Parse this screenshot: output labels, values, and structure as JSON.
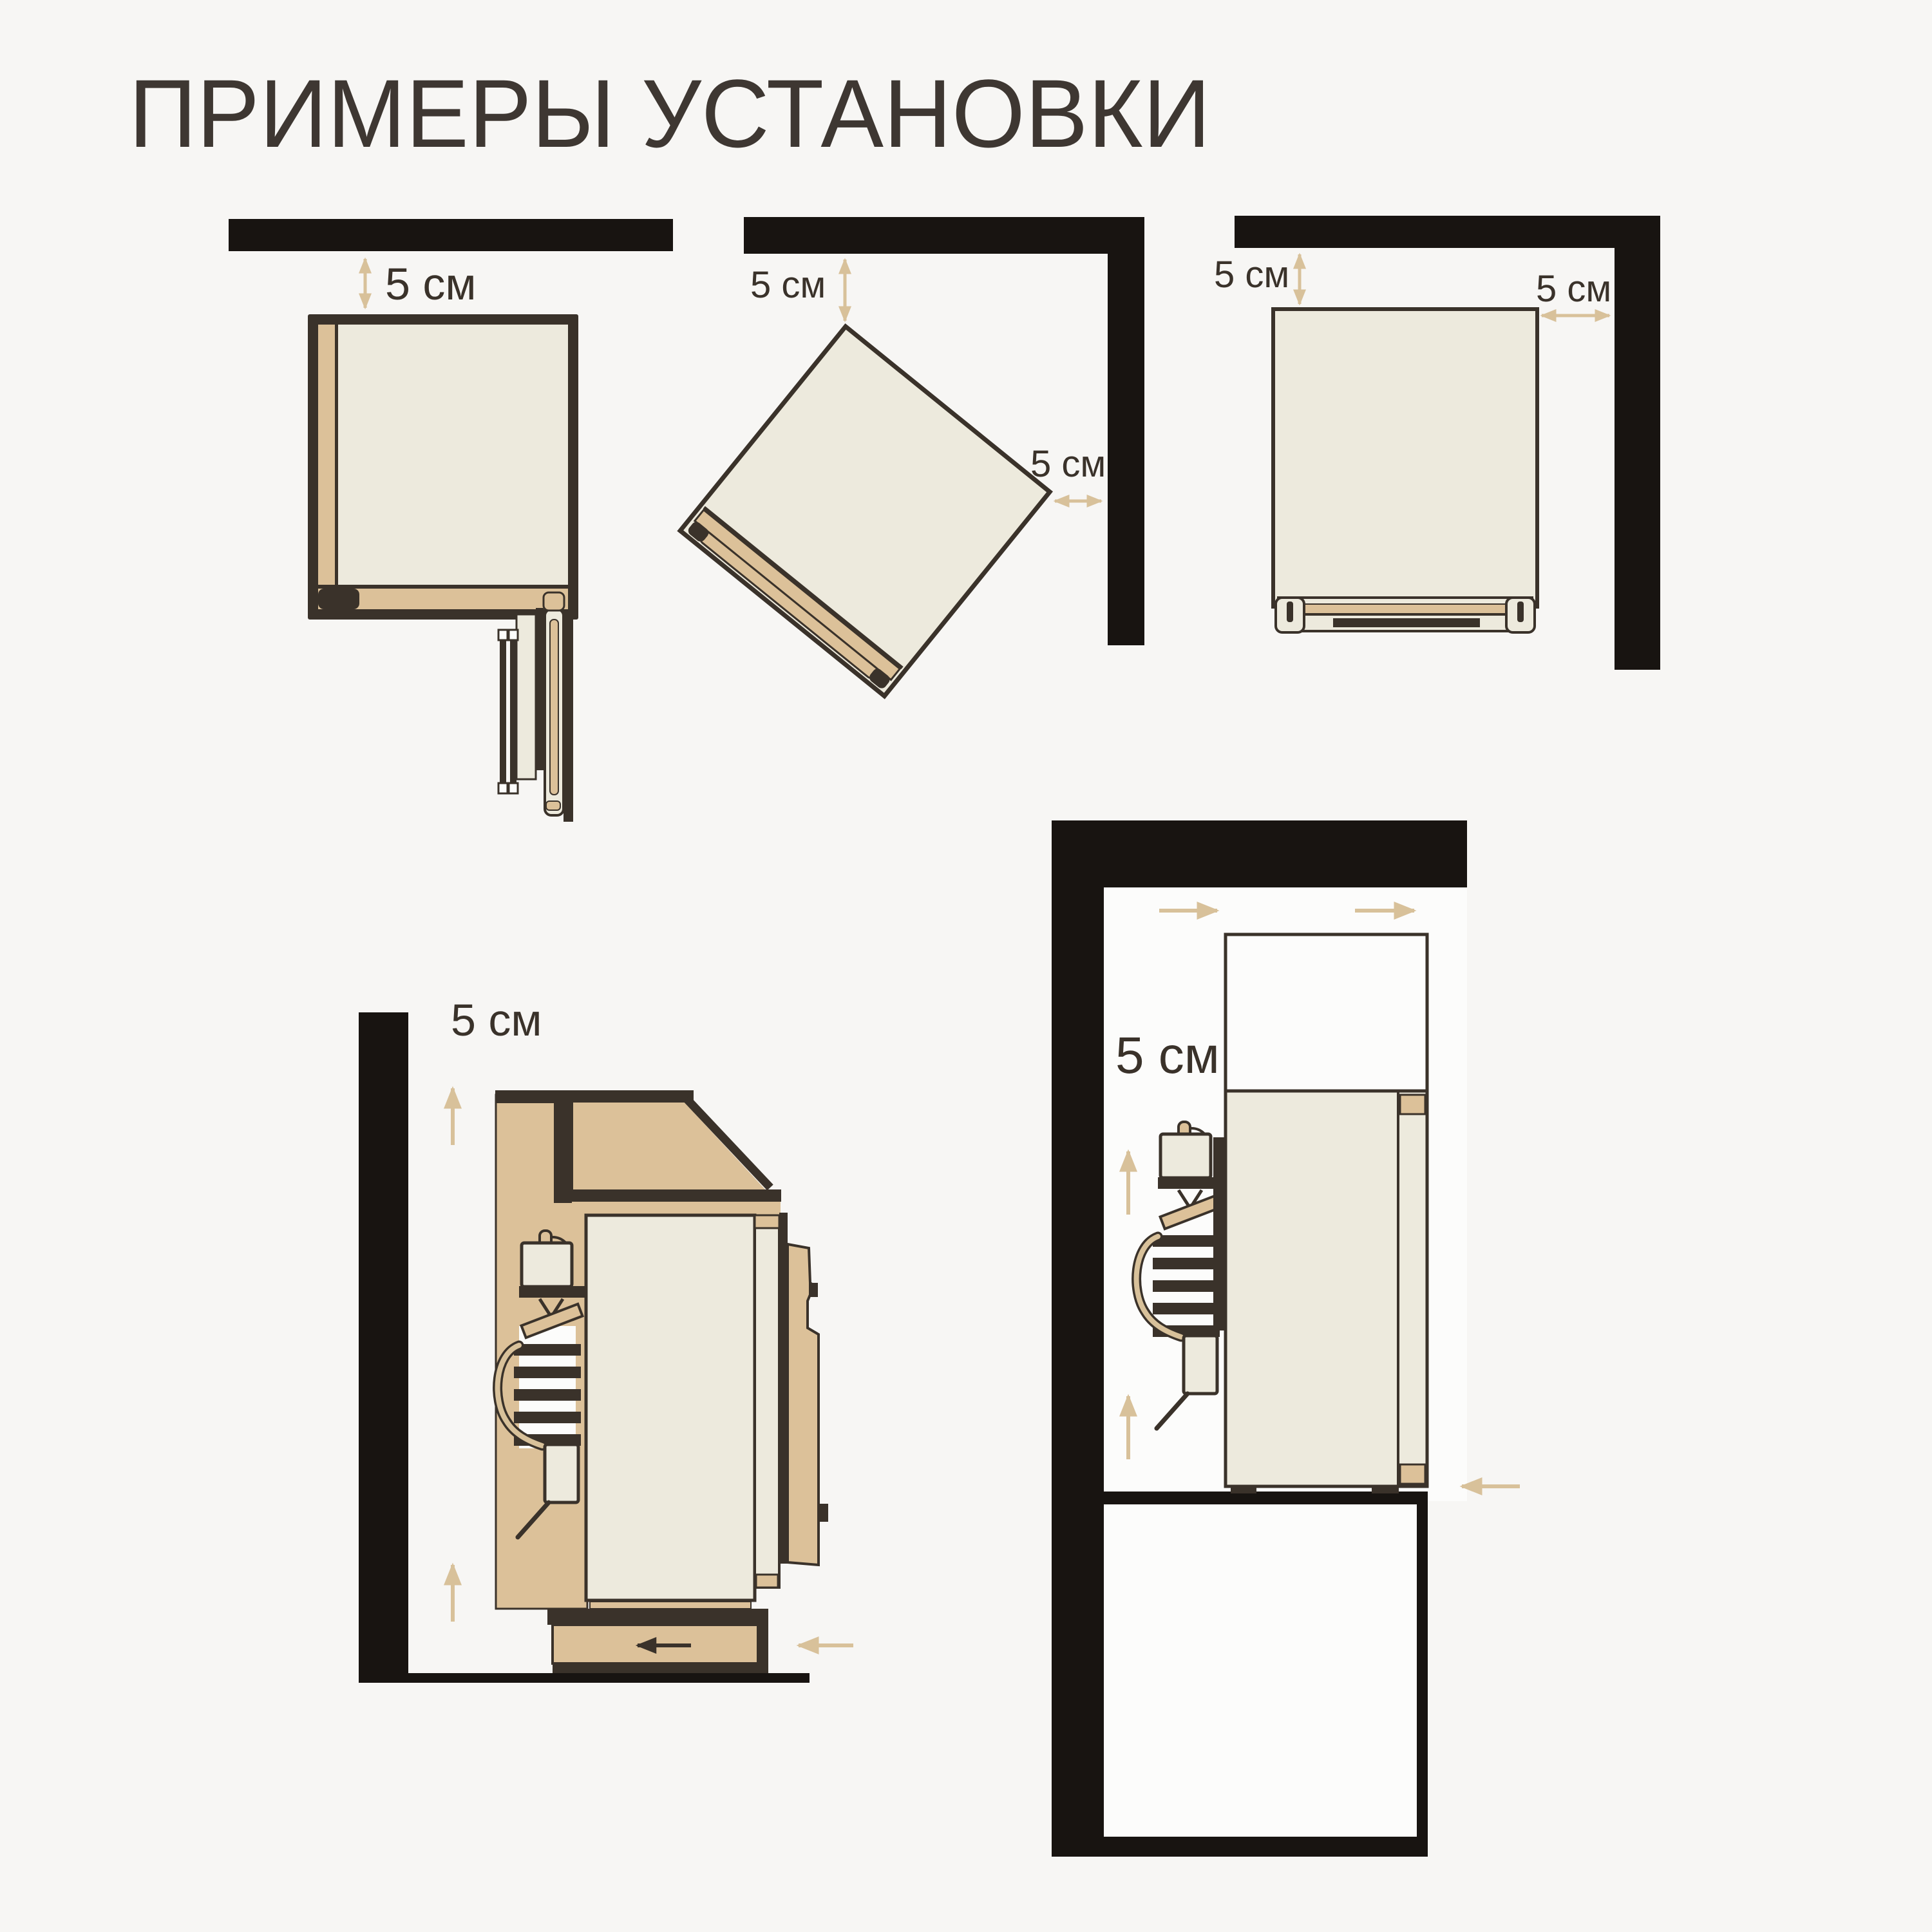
{
  "title": "ПРИМЕРЫ УСТАНОВКИ",
  "labels": {
    "d1_top": "5 см",
    "d2_top": "5 см",
    "d2_side": "5 см",
    "d3_top": "5 см",
    "d3_side": "5 см",
    "d4_rear": "5 см",
    "d5_side": "5 см"
  },
  "colors": {
    "background": "#f7f6f4",
    "wall": "#181411",
    "ink": "#3a322a",
    "cream": "#edeadd",
    "tan": "#dcc199",
    "arrow": "#d8c19a",
    "white": "#fcfcfb",
    "text": "#3a322a",
    "title": "#3e3732"
  }
}
